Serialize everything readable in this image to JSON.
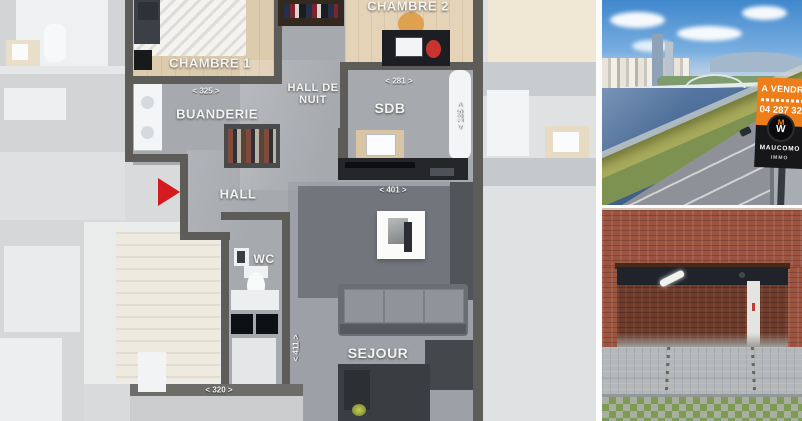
{
  "floorplan": {
    "labels": {
      "chambre1": "CHAMBRE 1",
      "chambre2": "CHAMBRE 2",
      "buanderie": "BUANDERIE",
      "hall_de_nuit": "HALL DE NUIT",
      "sdb": "SDB",
      "hall": "HALL",
      "wc": "WC",
      "sejour": "SEJOUR"
    },
    "dimensions": {
      "chambre1_width": "< 325 >",
      "sdb_width": "< 281 >",
      "sejour_width": "< 401 >",
      "terrace_width": "< 320 >",
      "sdb_depth": "< 185 >",
      "sejour_depth": "< 411 >"
    },
    "colors": {
      "wall": "#5e5c59",
      "floor": "#a6a9ae",
      "wood": "#ddcbae",
      "faded_background": "#d8dadc",
      "entrance_arrow": "#d31a1f"
    }
  },
  "photos": {
    "river_view": {
      "sign": {
        "status": "A VENDRE",
        "phone": "04 287 32",
        "agency": "MAUCOMO",
        "agency_sub": "IMMO",
        "logo_top": "M",
        "logo_letter": "W",
        "panel_color": "#ee7e19",
        "footer_color": "#17171a"
      }
    }
  }
}
